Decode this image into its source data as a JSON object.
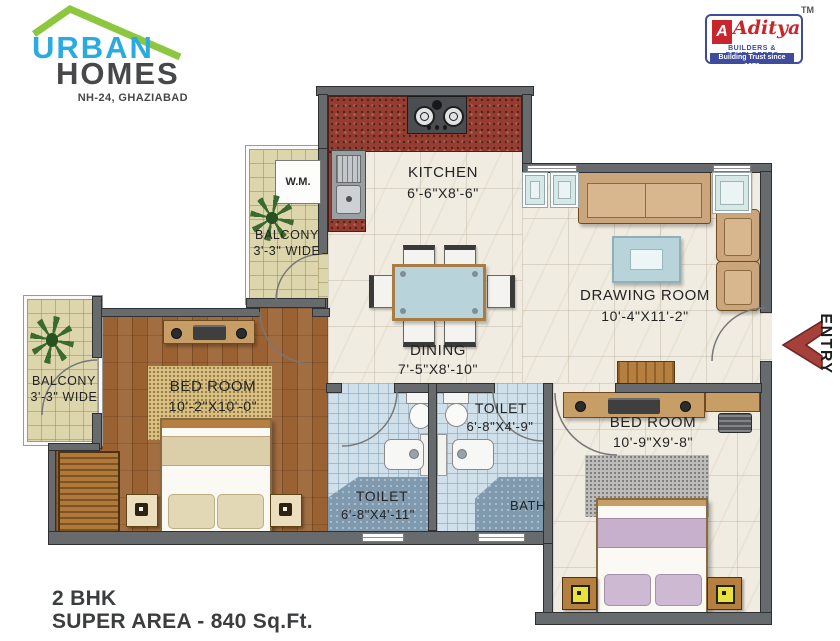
{
  "colors": {
    "urban_blue": "#29abe2",
    "logo_green": "#8dc63f",
    "logo_dark": "#47484a",
    "aditya_red": "#c9252c",
    "aditya_blue": "#3f4c9e",
    "entry_red": "#a5403a",
    "wall": "#686b6d",
    "cream": "#f1ece1",
    "wood": "#9a6233",
    "khaki": "#ddd5ab",
    "tile_blue": "#cfe0ea",
    "bath_blue": "#7f9aae",
    "granite": "#953d31",
    "tan": "#c79e66",
    "glass_teal": "#b9d3da",
    "purple": "#c6b0cb",
    "sand": "#d8c083"
  },
  "branding": {
    "urban": "URBAN",
    "homes": "HOMES",
    "tagline": "NH-24, GHAZIABAD",
    "aditya": {
      "tm": "TM",
      "letter": "A",
      "name": "Aditya",
      "builders": "BUILDERS & DEVELOPERS",
      "strip": "Building Trust since 1979"
    }
  },
  "entry_label": "ENTRY",
  "footer": {
    "line1": "2 BHK",
    "line2": "SUPER AREA - 840 Sq.Ft."
  },
  "rooms": {
    "kitchen": {
      "label": "KITCHEN",
      "dims": "6'-6\"X8'-6\""
    },
    "drawing_room": {
      "label": "DRAWING ROOM",
      "dims": "10'-4\"X11'-2\""
    },
    "dining": {
      "label": "DINING",
      "dims": "7'-5\"X8'-10\""
    },
    "bedroom1": {
      "label": "BED ROOM",
      "dims": "10'-2\"X10'-0\""
    },
    "bedroom2": {
      "label": "BED ROOM",
      "dims": "10'-9\"X9'-8\""
    },
    "toilet1": {
      "label": "TOILET",
      "dims": "6'-8\"X4'-11\""
    },
    "toilet2": {
      "label": "TOILET",
      "dims": "6'-8\"X4'-9\""
    },
    "bath": {
      "label": "BATH"
    },
    "balcony1": {
      "label": "BALCONY",
      "dims": "3'-3\" WIDE"
    },
    "balcony2": {
      "label": "BALCONY",
      "dims": "3'-3\" WIDE"
    },
    "washing_machine": "W.M."
  }
}
